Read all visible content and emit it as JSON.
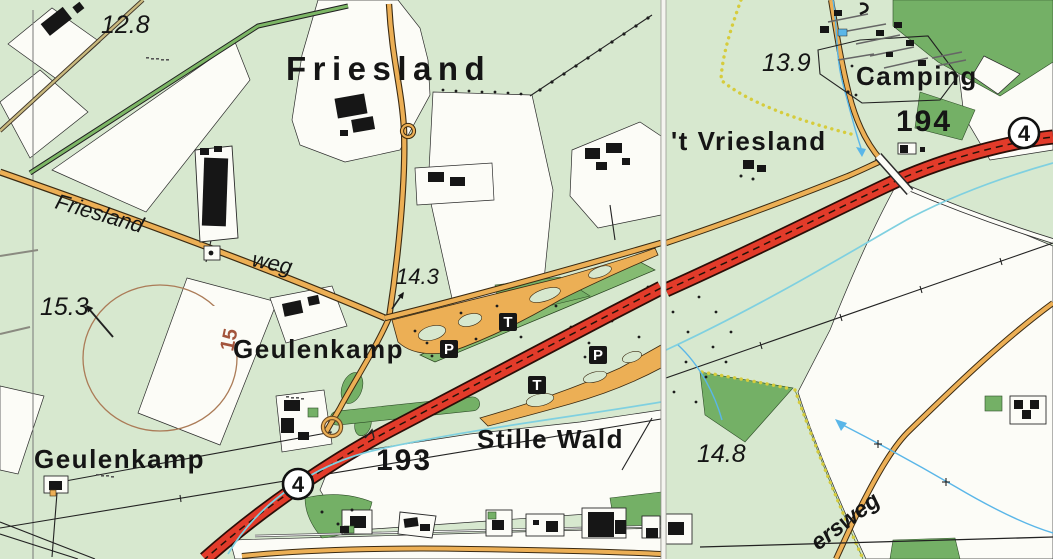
{
  "map": {
    "labels": {
      "region": "Friesland",
      "road_name_1": "Friesland",
      "road_name_2": "weg",
      "farm_1": "Geulenkamp",
      "farm_2": "Geulenkamp",
      "forest": "Stille Wald",
      "locality": "'t Vriesland",
      "campsite": "Camping",
      "road_name_3": "ersweg"
    },
    "elevations": {
      "spot_1": "12.8",
      "spot_2": "15.3",
      "spot_3": "14.3",
      "spot_4": "13.9",
      "spot_5": "14.8"
    },
    "markers": {
      "hm_1": "193",
      "hm_2": "194",
      "contour": "15"
    },
    "route": {
      "number": "4"
    },
    "amenities": {
      "parking": "P",
      "toilet": "T"
    }
  },
  "colors": {
    "field_green": "#d7e8cf",
    "forest_green": "#74b066",
    "median_green": "#85bb72",
    "road_orange": "#ecaf55",
    "motorway_red": "#e23b2a",
    "water_blue": "#7fd0e0",
    "stream_blue": "#5ab6e8",
    "path_yellow": "#d6cc3c",
    "contour_brown": "#ab7b57",
    "contour_label": "#a3543c",
    "white_field": "#fcfcf7",
    "ink": "#161616"
  }
}
